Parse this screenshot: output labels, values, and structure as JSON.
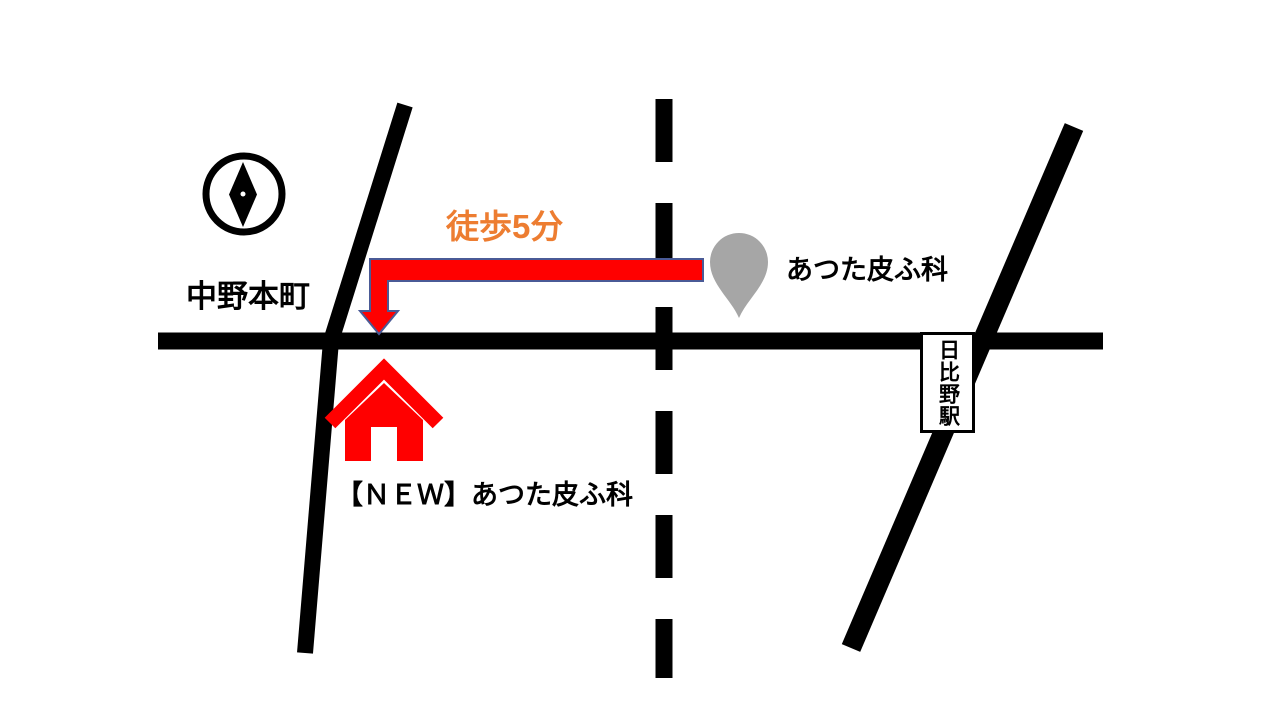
{
  "map": {
    "labels": {
      "road_name": "中野本町",
      "walk_time": "徒歩5分",
      "clinic_old": "あつた皮ふ科",
      "clinic_new": "【ＮＥＷ】あつた皮ふ科",
      "station": "日比野駅"
    },
    "icons": {
      "compass": "compass-icon",
      "destination_pin": "map-pin-icon",
      "new_location": "house-icon",
      "route": "walk-route-arrow-icon"
    }
  },
  "colors": {
    "bg": "#ffffff",
    "road": "#000000",
    "label-text": "#000000",
    "walk-text": "#ed7d31",
    "arrow-fill": "#ff0000",
    "arrow-outline": "#4a5a96",
    "pin": "#a6a6a6",
    "house": "#ff0000",
    "station-box-bg": "#ffffff"
  }
}
